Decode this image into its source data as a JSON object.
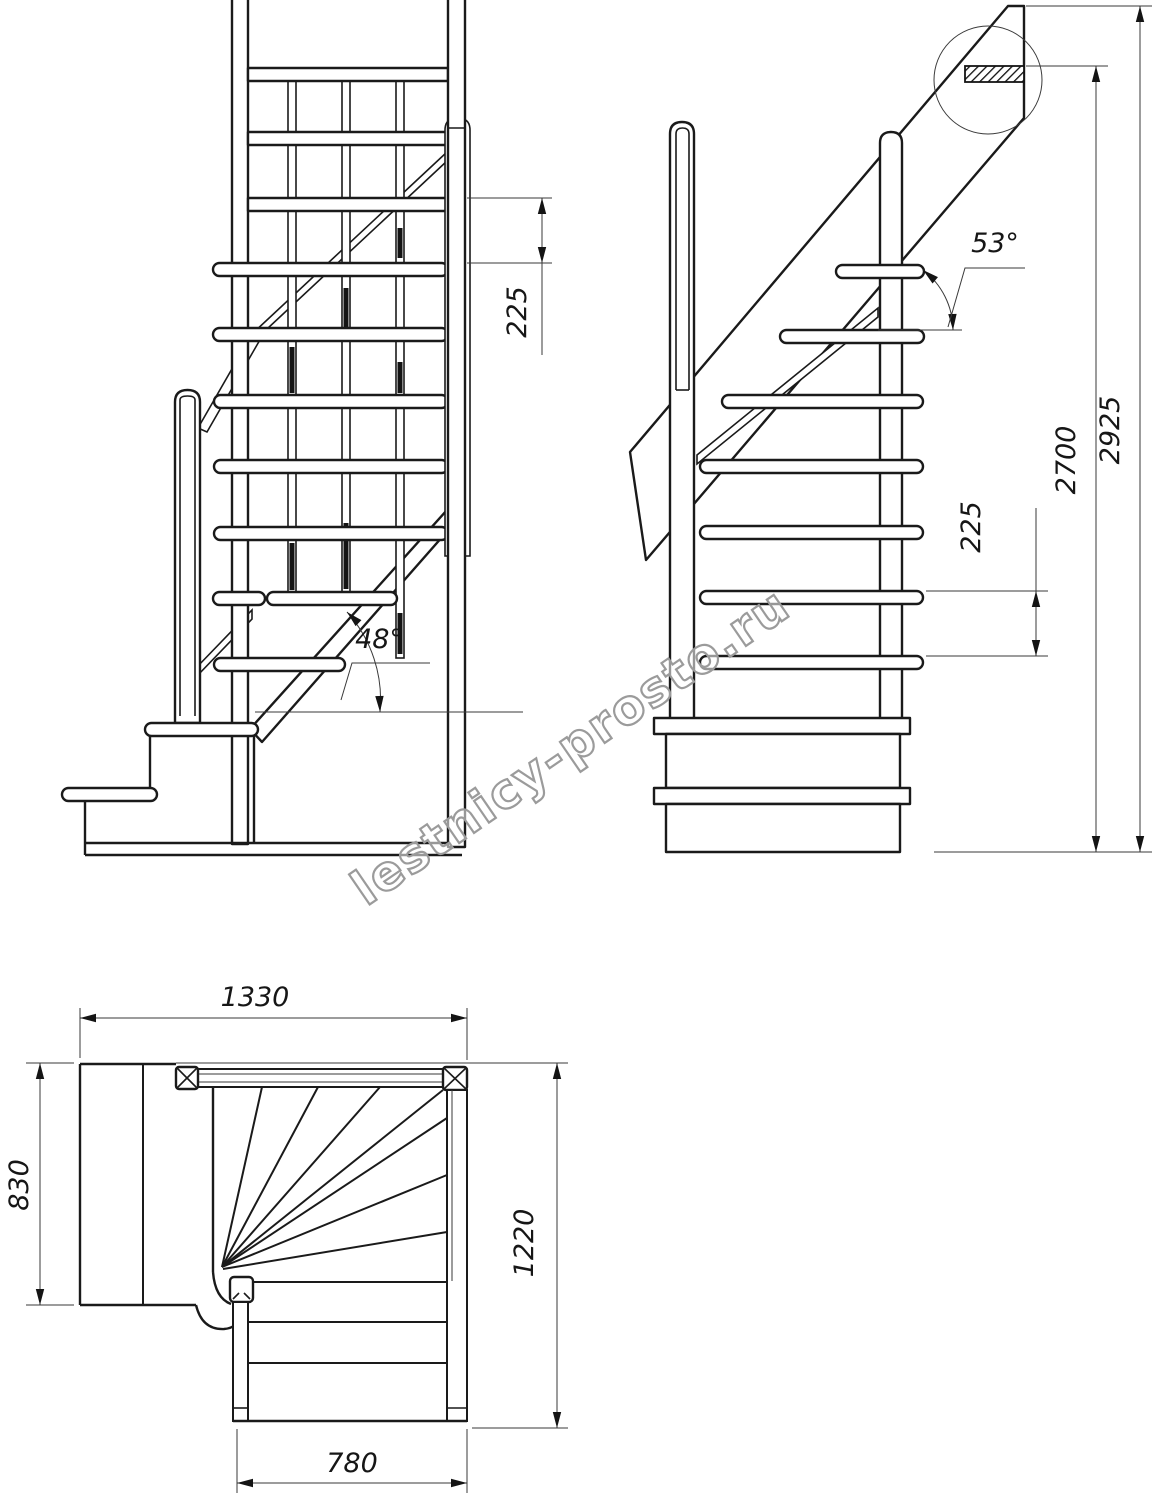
{
  "watermark": {
    "text": "lestnicy-prosto.ru"
  },
  "front_view": {
    "step_spacing": "225",
    "incline_angle": "48°"
  },
  "side_view": {
    "step_spacing": "225",
    "incline_angle": "53°",
    "floor_height": "2700",
    "total_height": "2925"
  },
  "plan_view": {
    "overall_width": "1330",
    "landing_depth": "830",
    "flight_length": "1220",
    "flight_width": "780"
  }
}
